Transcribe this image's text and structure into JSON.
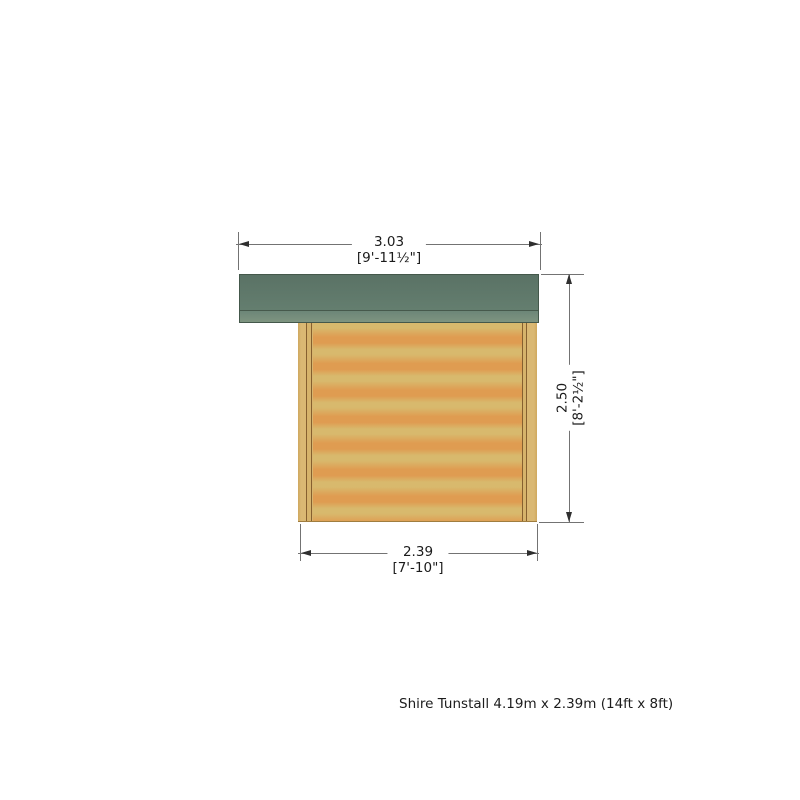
{
  "diagram": {
    "type": "shed-side-elevation",
    "caption": "Shire Tunstall 4.19m x 2.39m (14ft x 8ft)",
    "product": {
      "name": "Shire Tunstall",
      "size_metric": "4.19m x 2.39m",
      "size_imperial": "14ft x 8ft"
    },
    "dimensions": {
      "roof_width": {
        "metric": "3.03",
        "imperial": "[9'-11½\"]"
      },
      "wall_height": {
        "metric": "2.50",
        "imperial": "[8'-2½\"]"
      },
      "wall_width": {
        "metric": "2.39",
        "imperial": "[7'-10\"]"
      }
    },
    "colors": {
      "roof_main": "#61796c",
      "roof_fascia": "#72897a",
      "wall_light": "#d8b96d",
      "wall_orange": "#df9c51",
      "post_line": "#86602f",
      "dimension_line": "#737373",
      "text": "#1b1b1b",
      "background": "#ffffff"
    }
  }
}
